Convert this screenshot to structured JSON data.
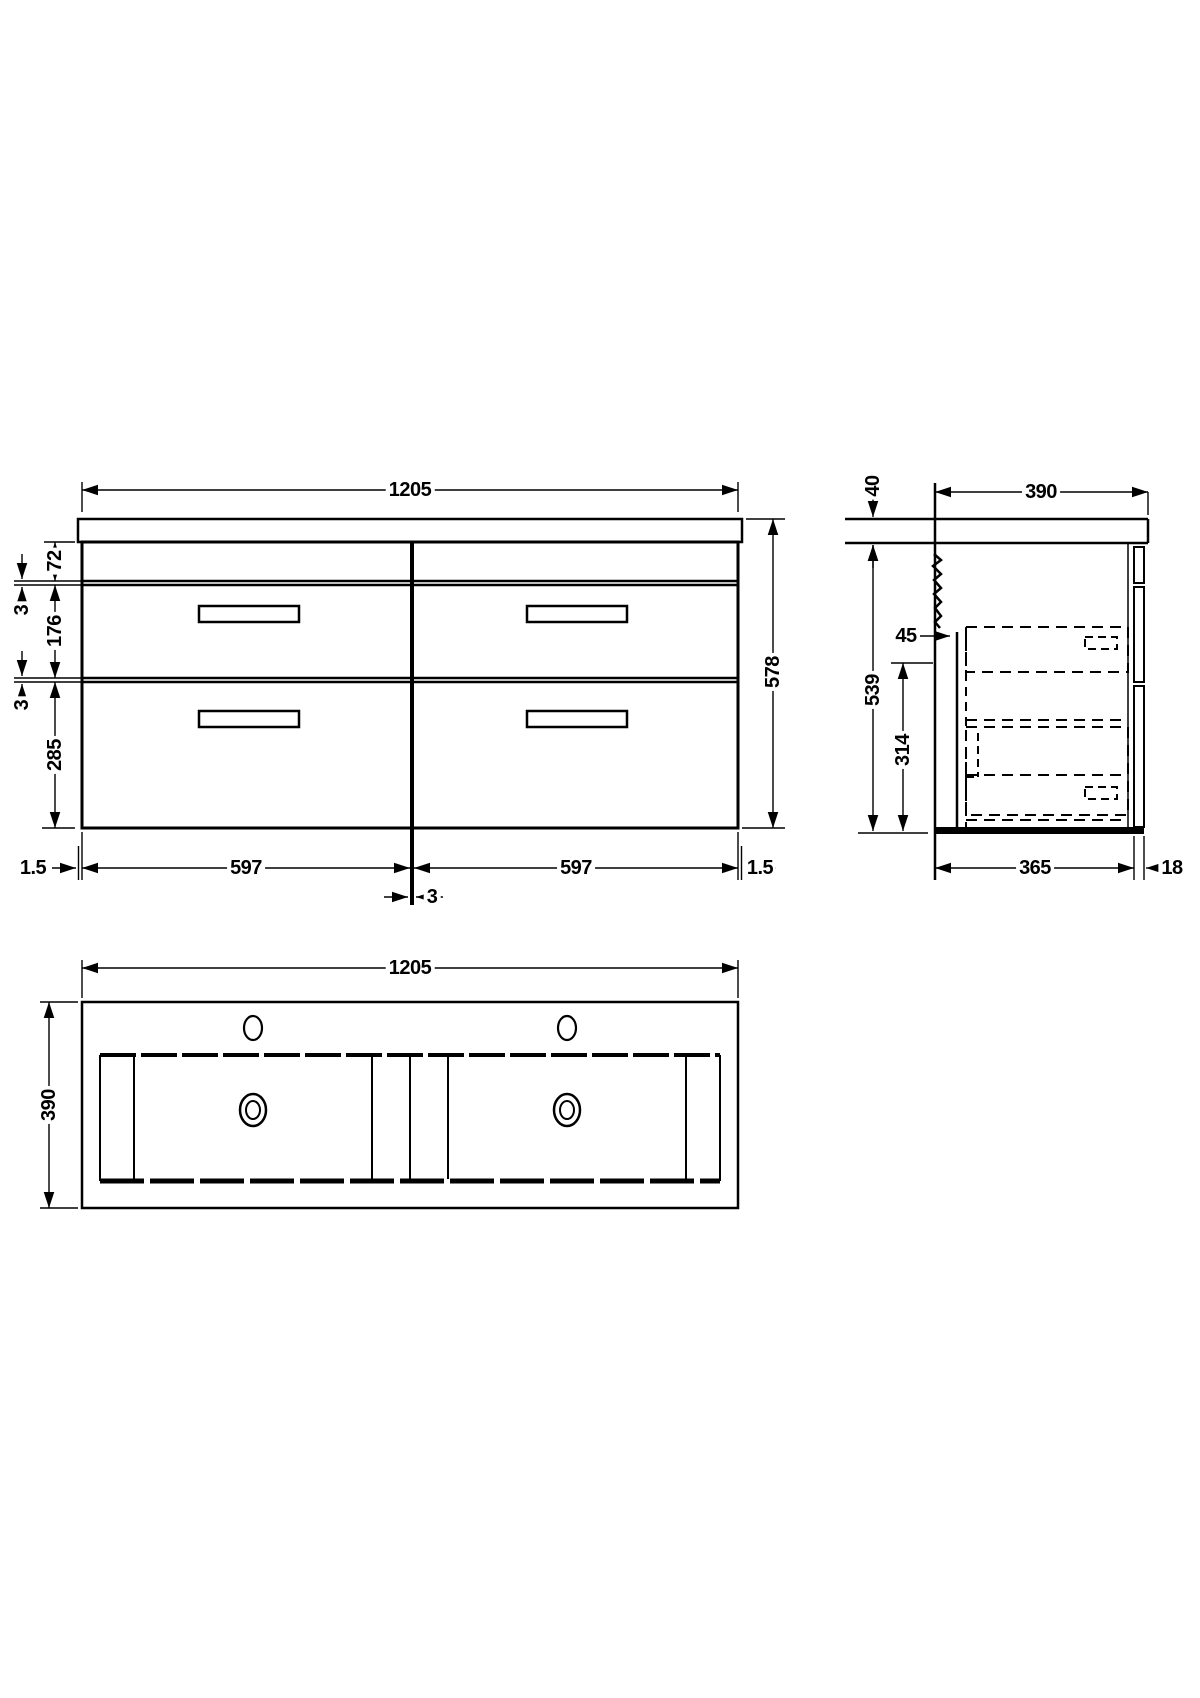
{
  "views": {
    "front": {
      "width": "1205",
      "total_height": "578",
      "top_drawer_height": "72",
      "gap_upper": "3",
      "middle_drawer_height": "176",
      "gap_lower": "3",
      "bottom_drawer_height": "285",
      "overhang_left": "1.5",
      "drawer_width_left": "597",
      "drawer_width_right": "597",
      "overhang_right": "1.5",
      "divider_thickness": "3"
    },
    "side": {
      "worktop_thickness": "40",
      "overall_depth": "390",
      "carcass_height": "539",
      "back_clearance": "45",
      "internal_height": "314",
      "carcass_depth": "365",
      "front_thickness": "18"
    },
    "plan": {
      "width": "1205",
      "depth": "390"
    }
  },
  "colors": {
    "line": "#000000",
    "background": "#ffffff"
  }
}
